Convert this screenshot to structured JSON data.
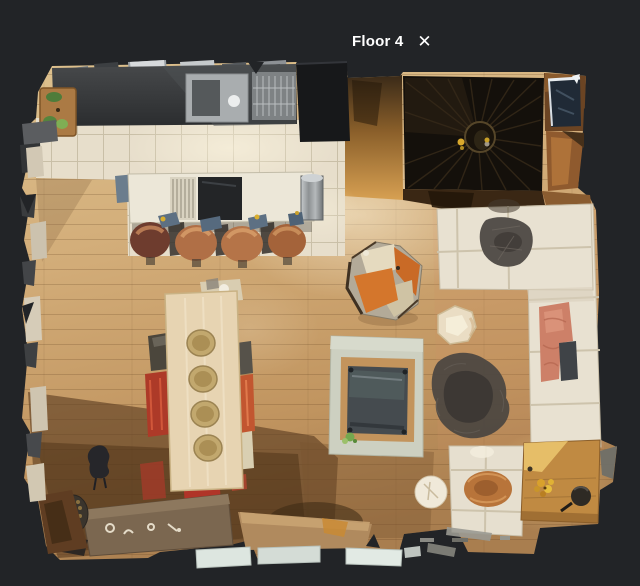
{
  "header": {
    "floor_label": "Floor 4",
    "close_icon": "✕"
  },
  "theme": {
    "background": "#222427",
    "header-text": "#ffffff",
    "floor-wood": "#cda76f",
    "kitchen-tile": "#e7decb",
    "sofa-fabric": "#e8e1d1",
    "armchair-orange": "#d4762c",
    "stair-well": "#14100b"
  }
}
